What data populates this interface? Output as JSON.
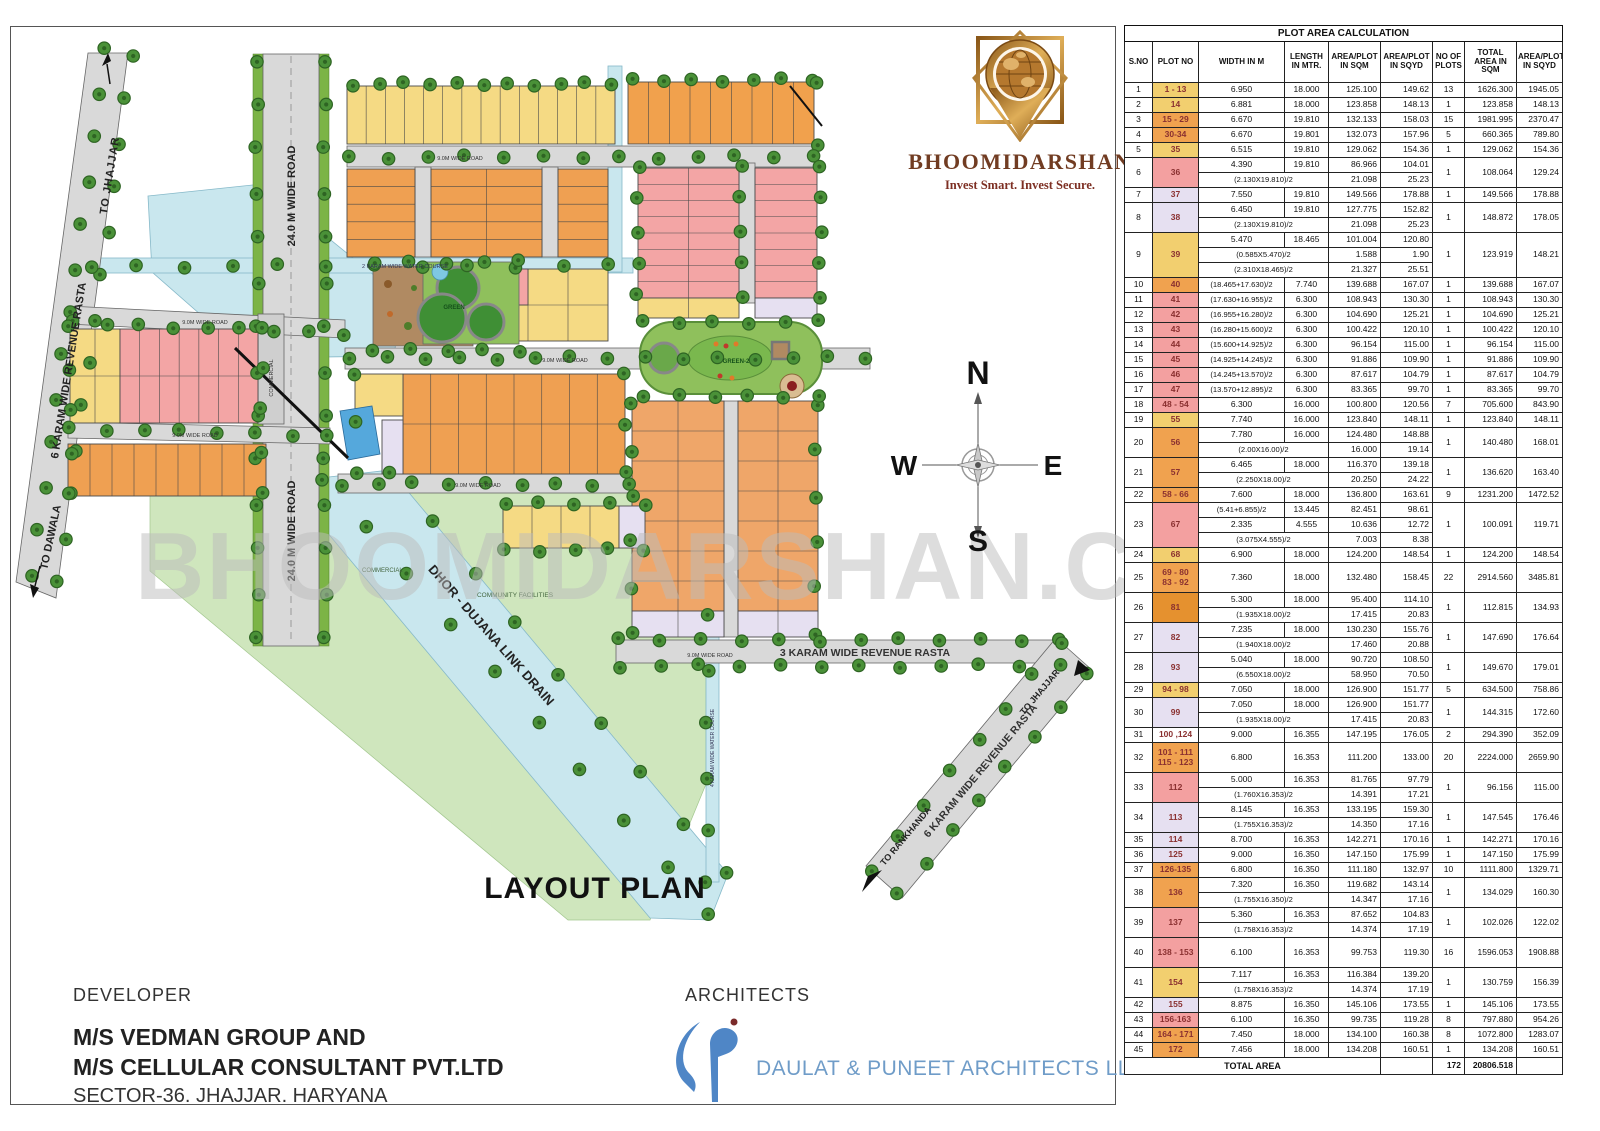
{
  "logo": {
    "brand": "BHOOMIDARSHAN",
    "tagline": "Invest Smart. Invest Secure.",
    "gold": "#b5782e",
    "maroon": "#713c22"
  },
  "watermark": "BHOOMIDARSHAN.COM",
  "compass": {
    "n": "N",
    "e": "E",
    "w": "W",
    "s": "S"
  },
  "map": {
    "title": "LAYOUT PLAN",
    "labels": {
      "to_jhajjar_top": "TO JHAJJAR",
      "revenue_rasta_left": "6 KARAM WIDE REVENUE RASTA",
      "to_dawala": "TO DAWALA",
      "road_24m": "24.0 M WIDE ROAD",
      "water_course_2k": "2 KARAM WIDE WATER COURSE",
      "water_course_4k": "4 KARAM WIDE WATER COURSE",
      "road_9m": "9.0M WIDE ROAD",
      "green1": "GREEN",
      "green2": "GREEN-2",
      "commercial": "COMMERCIAL",
      "community": "COMMUNITY FACILITIES",
      "drain": "DHOR - DUJANA LINK DRAIN",
      "rasta_3k": "3 KARAM WIDE REVENUE RASTA",
      "rasta_6k": "6 KARAM WIDE REVENUE RASTA",
      "to_rankhanda": "TO RANKHANDA",
      "to_jhajjar_right": "TO JHAJJAR"
    }
  },
  "developer": {
    "heading": "DEVELOPER",
    "line1": "M/S VEDMAN GROUP AND",
    "line2": "M/S CELLULAR CONSULTANT PVT.LTD",
    "line3": "SECTOR-36. JHAJJAR. HARYANA"
  },
  "architects": {
    "heading": "ARCHITECTS",
    "firm": "DAULAT & PUNEET ARCHITECTS LLP.",
    "blue": "#4f86c6"
  },
  "table": {
    "title": "PLOT AREA CALCULATION",
    "headers": [
      "S.NO",
      "PLOT NO",
      "WIDTH IN M",
      "LENGTH IN MTR.",
      "AREA/PLOT IN SQM",
      "AREA/PLOT IN SQYD",
      "NO OF PLOTS",
      "TOTAL AREA IN SQM",
      "AREA/PLOT IN SQYD"
    ],
    "plot_colors": {
      "y": "#f2cf6f",
      "o": "#f0a24f",
      "od": "#e5912f",
      "r": "#f3a0a0",
      "l": "#e6e0f1",
      "w": "#ffffff"
    },
    "rows": [
      {
        "sno": "1",
        "plot": "1 - 13",
        "c": "y",
        "lines": [
          [
            "6.950",
            "18.000",
            "125.100",
            "149.62"
          ]
        ],
        "plots": "13",
        "tsqm": "1626.300",
        "tsqyd": "1945.05"
      },
      {
        "sno": "2",
        "plot": "14",
        "c": "y",
        "lines": [
          [
            "6.881",
            "18.000",
            "123.858",
            "148.13"
          ]
        ],
        "plots": "1",
        "tsqm": "123.858",
        "tsqyd": "148.13"
      },
      {
        "sno": "3",
        "plot": "15 - 29",
        "c": "o",
        "lines": [
          [
            "6.670",
            "19.810",
            "132.133",
            "158.03"
          ]
        ],
        "plots": "15",
        "tsqm": "1981.995",
        "tsqyd": "2370.47"
      },
      {
        "sno": "4",
        "plot": "30-34",
        "c": "o",
        "lines": [
          [
            "6.670",
            "19.801",
            "132.073",
            "157.96"
          ]
        ],
        "plots": "5",
        "tsqm": "660.365",
        "tsqyd": "789.80"
      },
      {
        "sno": "5",
        "plot": "35",
        "c": "y",
        "lines": [
          [
            "6.515",
            "19.810",
            "129.062",
            "154.36"
          ]
        ],
        "plots": "1",
        "tsqm": "129.062",
        "tsqyd": "154.36"
      },
      {
        "sno": "6",
        "plot": "36",
        "c": "r",
        "lines": [
          [
            "4.390",
            "19.810",
            "86.966",
            "104.01"
          ],
          [
            "(2.130X19.810)/2",
            "",
            "21.098",
            "25.23"
          ]
        ],
        "plots": "1",
        "tsqm": "108.064",
        "tsqyd": "129.24"
      },
      {
        "sno": "7",
        "plot": "37",
        "c": "l",
        "lines": [
          [
            "7.550",
            "19.810",
            "149.566",
            "178.88"
          ]
        ],
        "plots": "1",
        "tsqm": "149.566",
        "tsqyd": "178.88"
      },
      {
        "sno": "8",
        "plot": "38",
        "c": "l",
        "lines": [
          [
            "6.450",
            "19.810",
            "127.775",
            "152.82"
          ],
          [
            "(2.130X19.810)/2",
            "",
            "21.098",
            "25.23"
          ]
        ],
        "plots": "1",
        "tsqm": "148.872",
        "tsqyd": "178.05"
      },
      {
        "sno": "9",
        "plot": "39",
        "c": "y",
        "lines": [
          [
            "5.470",
            "18.465",
            "101.004",
            "120.80"
          ],
          [
            "(0.585X5.470)/2",
            "",
            "1.588",
            "1.90"
          ],
          [
            "(2.310X18.465)/2",
            "",
            "21.327",
            "25.51"
          ]
        ],
        "plots": "1",
        "tsqm": "123.919",
        "tsqyd": "148.21"
      },
      {
        "sno": "10",
        "plot": "40",
        "c": "o",
        "lines": [
          [
            "(18.465+17.630)/2",
            "7.740",
            "139.688",
            "167.07"
          ]
        ],
        "plots": "1",
        "tsqm": "139.688",
        "tsqyd": "167.07"
      },
      {
        "sno": "11",
        "plot": "41",
        "c": "r",
        "lines": [
          [
            "(17.630+16.955)/2",
            "6.300",
            "108.943",
            "130.30"
          ]
        ],
        "plots": "1",
        "tsqm": "108.943",
        "tsqyd": "130.30"
      },
      {
        "sno": "12",
        "plot": "42",
        "c": "r",
        "lines": [
          [
            "(16.955+16.280)/2",
            "6.300",
            "104.690",
            "125.21"
          ]
        ],
        "plots": "1",
        "tsqm": "104.690",
        "tsqyd": "125.21"
      },
      {
        "sno": "13",
        "plot": "43",
        "c": "r",
        "lines": [
          [
            "(16.280+15.600)/2",
            "6.300",
            "100.422",
            "120.10"
          ]
        ],
        "plots": "1",
        "tsqm": "100.422",
        "tsqyd": "120.10"
      },
      {
        "sno": "14",
        "plot": "44",
        "c": "r",
        "lines": [
          [
            "(15.600+14.925)/2",
            "6.300",
            "96.154",
            "115.00"
          ]
        ],
        "plots": "1",
        "tsqm": "96.154",
        "tsqyd": "115.00"
      },
      {
        "sno": "15",
        "plot": "45",
        "c": "r",
        "lines": [
          [
            "(14.925+14.245)/2",
            "6.300",
            "91.886",
            "109.90"
          ]
        ],
        "plots": "1",
        "tsqm": "91.886",
        "tsqyd": "109.90"
      },
      {
        "sno": "16",
        "plot": "46",
        "c": "r",
        "lines": [
          [
            "(14.245+13.570)/2",
            "6.300",
            "87.617",
            "104.79"
          ]
        ],
        "plots": "1",
        "tsqm": "87.617",
        "tsqyd": "104.79"
      },
      {
        "sno": "17",
        "plot": "47",
        "c": "r",
        "lines": [
          [
            "(13.570+12.895)/2",
            "6.300",
            "83.365",
            "99.70"
          ]
        ],
        "plots": "1",
        "tsqm": "83.365",
        "tsqyd": "99.70"
      },
      {
        "sno": "18",
        "plot": "48 - 54",
        "c": "r",
        "lines": [
          [
            "6.300",
            "16.000",
            "100.800",
            "120.56"
          ]
        ],
        "plots": "7",
        "tsqm": "705.600",
        "tsqyd": "843.90"
      },
      {
        "sno": "19",
        "plot": "55",
        "c": "y",
        "lines": [
          [
            "7.740",
            "16.000",
            "123.840",
            "148.11"
          ]
        ],
        "plots": "1",
        "tsqm": "123.840",
        "tsqyd": "148.11"
      },
      {
        "sno": "20",
        "plot": "56",
        "c": "o",
        "lines": [
          [
            "7.780",
            "16.000",
            "124.480",
            "148.88"
          ],
          [
            "(2.00X16.00)/2",
            "",
            "16.000",
            "19.14"
          ]
        ],
        "plots": "1",
        "tsqm": "140.480",
        "tsqyd": "168.01"
      },
      {
        "sno": "21",
        "plot": "57",
        "c": "o",
        "lines": [
          [
            "6.465",
            "18.000",
            "116.370",
            "139.18"
          ],
          [
            "(2.250X18.00)/2",
            "",
            "20.250",
            "24.22"
          ]
        ],
        "plots": "1",
        "tsqm": "136.620",
        "tsqyd": "163.40"
      },
      {
        "sno": "22",
        "plot": "58 - 66",
        "c": "o",
        "lines": [
          [
            "7.600",
            "18.000",
            "136.800",
            "163.61"
          ]
        ],
        "plots": "9",
        "tsqm": "1231.200",
        "tsqyd": "1472.52"
      },
      {
        "sno": "23",
        "plot": "67",
        "c": "r",
        "lines": [
          [
            "(5.41+6.855)/2",
            "13.445",
            "82.451",
            "98.61"
          ],
          [
            "2.335",
            "4.555",
            "10.636",
            "12.72"
          ],
          [
            "(3.075X4.555)/2",
            "",
            "7.003",
            "8.38"
          ]
        ],
        "plots": "1",
        "tsqm": "100.091",
        "tsqyd": "119.71"
      },
      {
        "sno": "24",
        "plot": "68",
        "c": "y",
        "lines": [
          [
            "6.900",
            "18.000",
            "124.200",
            "148.54"
          ]
        ],
        "plots": "1",
        "tsqm": "124.200",
        "tsqyd": "148.54"
      },
      {
        "sno": "25",
        "plot": "69 - 80\n83 - 92",
        "c": "o",
        "lines": [
          [
            "7.360",
            "18.000",
            "132.480",
            "158.45"
          ]
        ],
        "plots": "22",
        "tsqm": "2914.560",
        "tsqyd": "3485.81"
      },
      {
        "sno": "26",
        "plot": "81",
        "c": "od",
        "lines": [
          [
            "5.300",
            "18.000",
            "95.400",
            "114.10"
          ],
          [
            "(1.935X18.00)/2",
            "",
            "17.415",
            "20.83"
          ]
        ],
        "plots": "1",
        "tsqm": "112.815",
        "tsqyd": "134.93"
      },
      {
        "sno": "27",
        "plot": "82",
        "c": "l",
        "lines": [
          [
            "7.235",
            "18.000",
            "130.230",
            "155.76"
          ],
          [
            "(1.940X18.00)/2",
            "",
            "17.460",
            "20.88"
          ]
        ],
        "plots": "1",
        "tsqm": "147.690",
        "tsqyd": "176.64"
      },
      {
        "sno": "28",
        "plot": "93",
        "c": "l",
        "lines": [
          [
            "5.040",
            "18.000",
            "90.720",
            "108.50"
          ],
          [
            "(6.550X18.00)/2",
            "",
            "58.950",
            "70.50"
          ]
        ],
        "plots": "1",
        "tsqm": "149.670",
        "tsqyd": "179.01"
      },
      {
        "sno": "29",
        "plot": "94 - 98",
        "c": "y",
        "lines": [
          [
            "7.050",
            "18.000",
            "126.900",
            "151.77"
          ]
        ],
        "plots": "5",
        "tsqm": "634.500",
        "tsqyd": "758.86"
      },
      {
        "sno": "30",
        "plot": "99",
        "c": "l",
        "lines": [
          [
            "7.050",
            "18.000",
            "126.900",
            "151.77"
          ],
          [
            "(1.935X18.00)/2",
            "",
            "17.415",
            "20.83"
          ]
        ],
        "plots": "1",
        "tsqm": "144.315",
        "tsqyd": "172.60"
      },
      {
        "sno": "31",
        "plot": "100 ,124",
        "c": "w",
        "lines": [
          [
            "9.000",
            "16.355",
            "147.195",
            "176.05"
          ]
        ],
        "plots": "2",
        "tsqm": "294.390",
        "tsqyd": "352.09"
      },
      {
        "sno": "32",
        "plot": "101 - 111\n115 - 123",
        "c": "o",
        "lines": [
          [
            "6.800",
            "16.353",
            "111.200",
            "133.00"
          ]
        ],
        "plots": "20",
        "tsqm": "2224.000",
        "tsqyd": "2659.90"
      },
      {
        "sno": "33",
        "plot": "112",
        "c": "r",
        "lines": [
          [
            "5.000",
            "16.353",
            "81.765",
            "97.79"
          ],
          [
            "(1.760X16.353)/2",
            "",
            "14.391",
            "17.21"
          ]
        ],
        "plots": "1",
        "tsqm": "96.156",
        "tsqyd": "115.00"
      },
      {
        "sno": "34",
        "plot": "113",
        "c": "l",
        "lines": [
          [
            "8.145",
            "16.353",
            "133.195",
            "159.30"
          ],
          [
            "(1.755X16.353)/2",
            "",
            "14.350",
            "17.16"
          ]
        ],
        "plots": "1",
        "tsqm": "147.545",
        "tsqyd": "176.46"
      },
      {
        "sno": "35",
        "plot": "114",
        "c": "l",
        "lines": [
          [
            "8.700",
            "16.353",
            "142.271",
            "170.16"
          ]
        ],
        "plots": "1",
        "tsqm": "142.271",
        "tsqyd": "170.16"
      },
      {
        "sno": "36",
        "plot": "125",
        "c": "l",
        "lines": [
          [
            "9.000",
            "16.350",
            "147.150",
            "175.99"
          ]
        ],
        "plots": "1",
        "tsqm": "147.150",
        "tsqyd": "175.99"
      },
      {
        "sno": "37",
        "plot": "126-135",
        "c": "o",
        "lines": [
          [
            "6.800",
            "16.350",
            "111.180",
            "132.97"
          ]
        ],
        "plots": "10",
        "tsqm": "1111.800",
        "tsqyd": "1329.71"
      },
      {
        "sno": "38",
        "plot": "136",
        "c": "o",
        "lines": [
          [
            "7.320",
            "16.350",
            "119.682",
            "143.14"
          ],
          [
            "(1.755X16.350)/2",
            "",
            "14.347",
            "17.16"
          ]
        ],
        "plots": "1",
        "tsqm": "134.029",
        "tsqyd": "160.30"
      },
      {
        "sno": "39",
        "plot": "137",
        "c": "r",
        "lines": [
          [
            "5.360",
            "16.353",
            "87.652",
            "104.83"
          ],
          [
            "(1.758X16.353)/2",
            "",
            "14.374",
            "17.19"
          ]
        ],
        "plots": "1",
        "tsqm": "102.026",
        "tsqyd": "122.02"
      },
      {
        "sno": "40",
        "plot": "138 - 153",
        "c": "r",
        "lines": [
          [
            "6.100",
            "16.353",
            "99.753",
            "119.30"
          ]
        ],
        "plots": "16",
        "tsqm": "1596.053",
        "tsqyd": "1908.88",
        "tall": true
      },
      {
        "sno": "41",
        "plot": "154",
        "c": "y",
        "lines": [
          [
            "7.117",
            "16.353",
            "116.384",
            "139.20"
          ],
          [
            "(1.758X16.353)/2",
            "",
            "14.374",
            "17.19"
          ]
        ],
        "plots": "1",
        "tsqm": "130.759",
        "tsqyd": "156.39"
      },
      {
        "sno": "42",
        "plot": "155",
        "c": "l",
        "lines": [
          [
            "8.875",
            "16.350",
            "145.106",
            "173.55"
          ]
        ],
        "plots": "1",
        "tsqm": "145.106",
        "tsqyd": "173.55"
      },
      {
        "sno": "43",
        "plot": "156-163",
        "c": "r",
        "lines": [
          [
            "6.100",
            "16.350",
            "99.735",
            "119.28"
          ]
        ],
        "plots": "8",
        "tsqm": "797.880",
        "tsqyd": "954.26"
      },
      {
        "sno": "44",
        "plot": "164 - 171",
        "c": "o",
        "lines": [
          [
            "7.450",
            "18.000",
            "134.100",
            "160.38"
          ]
        ],
        "plots": "8",
        "tsqm": "1072.800",
        "tsqyd": "1283.07"
      },
      {
        "sno": "45",
        "plot": "172",
        "c": "o",
        "lines": [
          [
            "7.456",
            "18.000",
            "134.208",
            "160.51"
          ]
        ],
        "plots": "1",
        "tsqm": "134.208",
        "tsqyd": "160.51"
      }
    ],
    "total": {
      "label": "TOTAL AREA",
      "plots": "172",
      "area_sqm": "20806.518"
    }
  }
}
